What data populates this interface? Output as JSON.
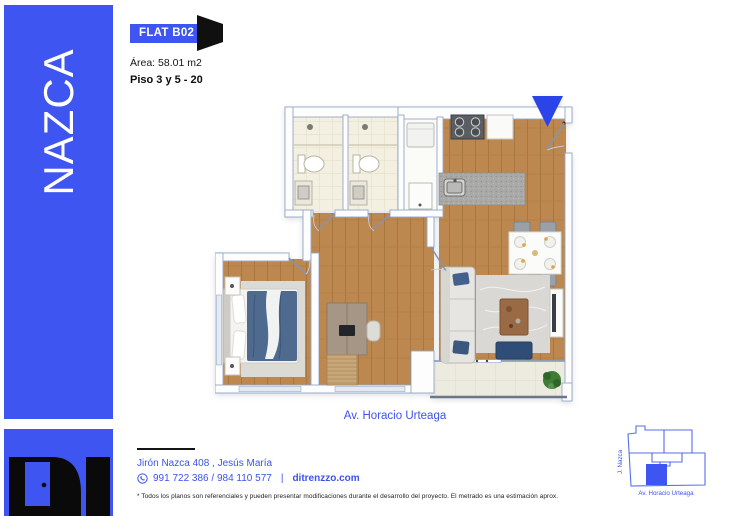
{
  "brand": {
    "name": "NAZCA",
    "logo_text": "DI"
  },
  "unit": {
    "badge": "FLAT B02",
    "area": "Área: 58.01 m2",
    "floors": "Piso 3 y 5 - 20"
  },
  "plan": {
    "street": "Av. Horacio Urteaga"
  },
  "footer": {
    "address": "Jirón Nazca 408 , Jesús María",
    "phones": "991 722 386 / 984 110 577",
    "separator": "|",
    "website": "ditrenzzo.com",
    "disclaimer": "* Todos los planos son referenciales y pueden presentar modificaciones durante el desarrollo del proyecto. El metrado es una estimación aprox."
  },
  "minimap": {
    "street_side": "J. Nazca",
    "street_front": "Av. Horacio Urteaga"
  },
  "icons": {
    "door_badge": "door-icon",
    "entrance_arrow": "down-arrow-icon",
    "phone": "phone-circle-icon"
  },
  "colors": {
    "accent": "#3e55f2",
    "arrow": "#2b44ea",
    "wood": "#bd8850"
  }
}
